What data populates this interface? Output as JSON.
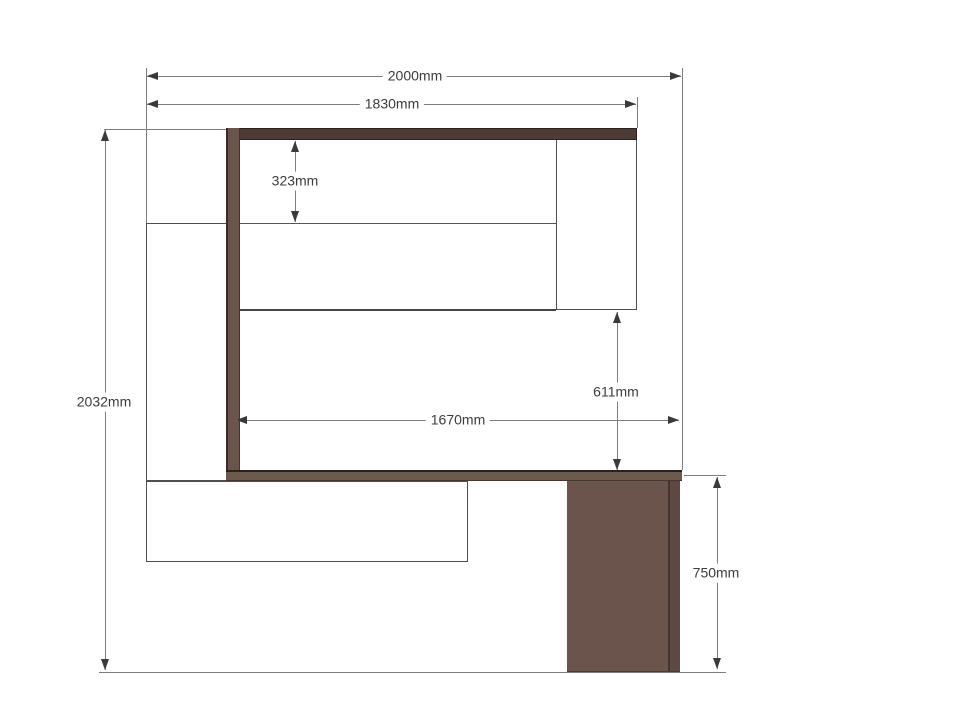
{
  "drawing": {
    "type": "furniture-elevation-dimension-drawing",
    "units": "mm",
    "labels": {
      "overall_width": "2000mm",
      "upper_width": "1830mm",
      "inset_height": "323mm",
      "overall_height": "2032mm",
      "inner_width": "1670mm",
      "clearance_height": "611mm",
      "desk_height": "750mm"
    },
    "colors": {
      "background": "#ffffff",
      "wood_top_rail": "#4f3b35",
      "wood_side_rail": "#6b544b",
      "wood_desk_top": "#6e5a4a",
      "wood_desk_leg": "#6b544c",
      "panel_fill": "#ffffff",
      "panel_outline": "#4f4f4f",
      "dimension_line": "#7d7d7d",
      "arrow": "#3a3a3a",
      "text": "#3c3c3c"
    }
  }
}
